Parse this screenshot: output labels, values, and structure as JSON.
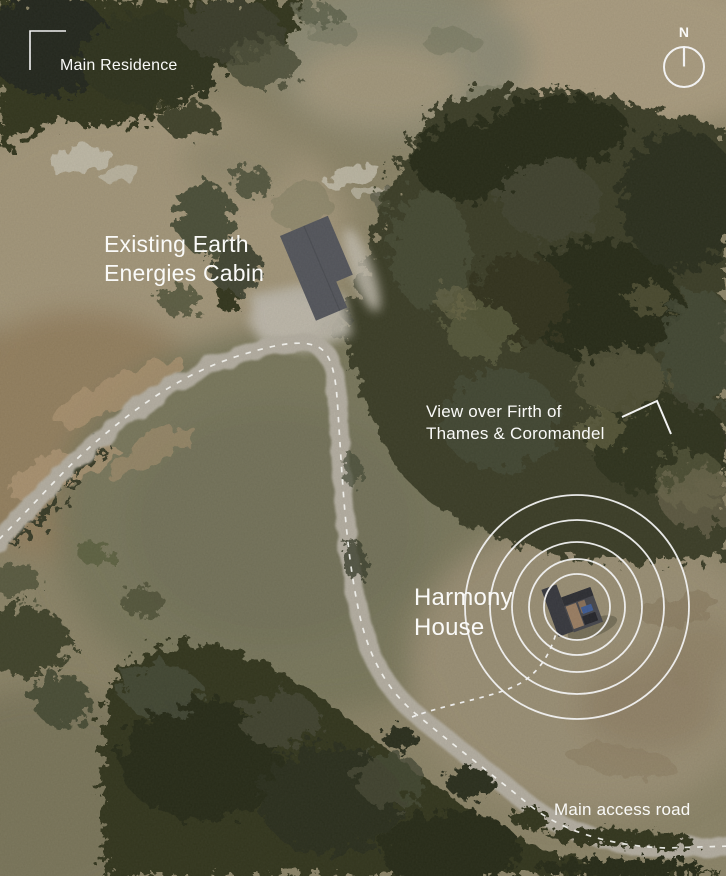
{
  "map": {
    "compass": {
      "label": "N"
    },
    "annotations": {
      "main_residence": {
        "label": "Main Residence"
      },
      "existing_cabin": {
        "line1": "Existing Earth",
        "line2": "Energies Cabin"
      },
      "view": {
        "line1": "View over Firth of",
        "line2": "Thames & Coromandel"
      },
      "harmony_house": {
        "line1": "Harmony",
        "line2": "House"
      },
      "main_access_road": {
        "label": "Main access road"
      }
    },
    "harmony_rings": {
      "count": 5,
      "radii": [
        33,
        48,
        65,
        87,
        112
      ]
    },
    "colors": {
      "annotation_text": "#fafaf8",
      "annotation_lines": "#ffffff",
      "road_surface": "#b6b0a3",
      "road_centerline": "#fdfdf8",
      "grass_olive": "#7a785c",
      "grass_khaki": "#9b9074",
      "earth_brown": "#95815f",
      "forest_dark": "#2d301e",
      "cabin_roof": "#54565c",
      "harmony_roof": "#37383e"
    }
  }
}
